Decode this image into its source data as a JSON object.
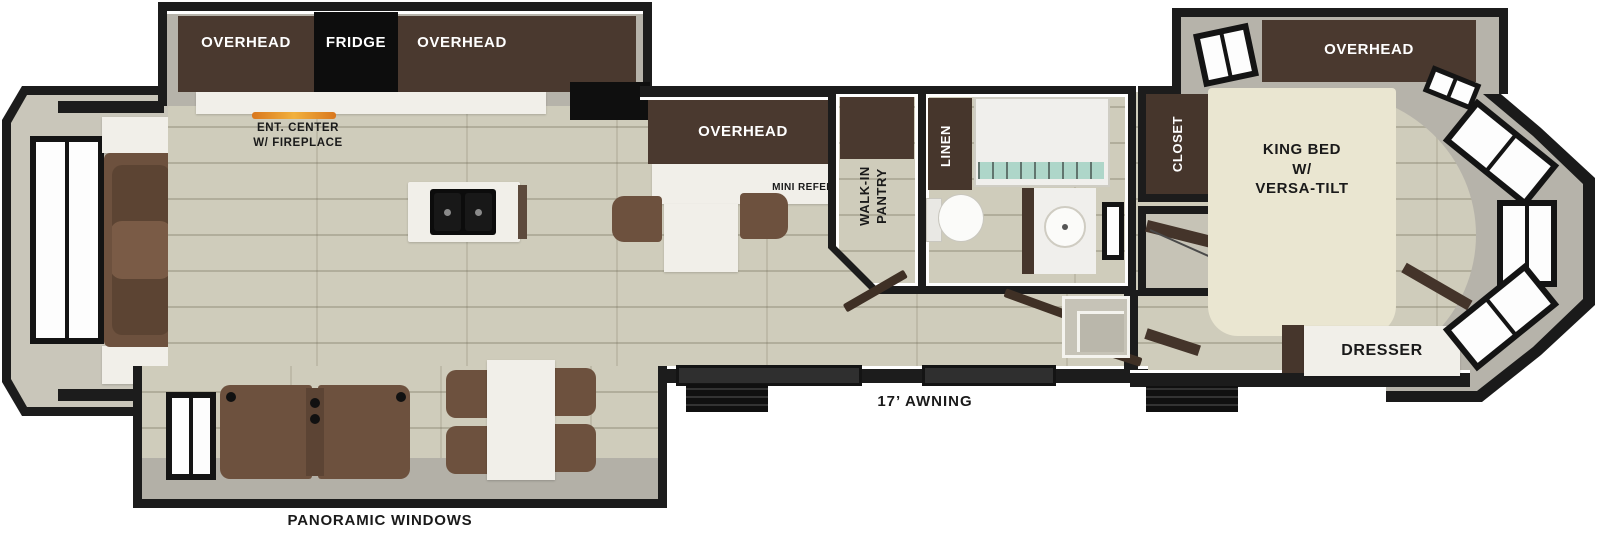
{
  "type": "rv-floorplan-diagram",
  "labels": {
    "overhead": "OVERHEAD",
    "fridge": "FRIDGE",
    "ent_center": {
      "line1": "ENT. CENTER",
      "line2": "W/ FIREPLACE"
    },
    "mini_refer": "MINI REFER",
    "pantry": {
      "line1": "WALK-IN",
      "line2": "PANTRY"
    },
    "linen": "LINEN",
    "closet": "CLOSET",
    "king_bed": {
      "line1": "KING BED",
      "line2": "W/",
      "line3": "VERSA-TILT"
    },
    "washer_dryer": {
      "line1": "WASHER",
      "line2": "DRYER PREP"
    },
    "dresser": "DRESSER",
    "awning": "17’ AWNING",
    "panoramic_windows": "PANORAMIC WINDOWS"
  },
  "colors": {
    "wall": "#1c1c1c",
    "wall_fill_gray": "#b6b3aa",
    "floor": "#cfccbb",
    "cabinet_brown": "#4a392f",
    "counter_white": "#f1efe9",
    "seat_brown": "#6d513e",
    "bed_cream": "#eae6d1",
    "appliance_black": "#0d0d0d",
    "fireplace_flame": "#f2a93d",
    "shower_water": "#aed6c9",
    "label_dark": "#1a1a1a",
    "label_light": "#ffffff"
  }
}
